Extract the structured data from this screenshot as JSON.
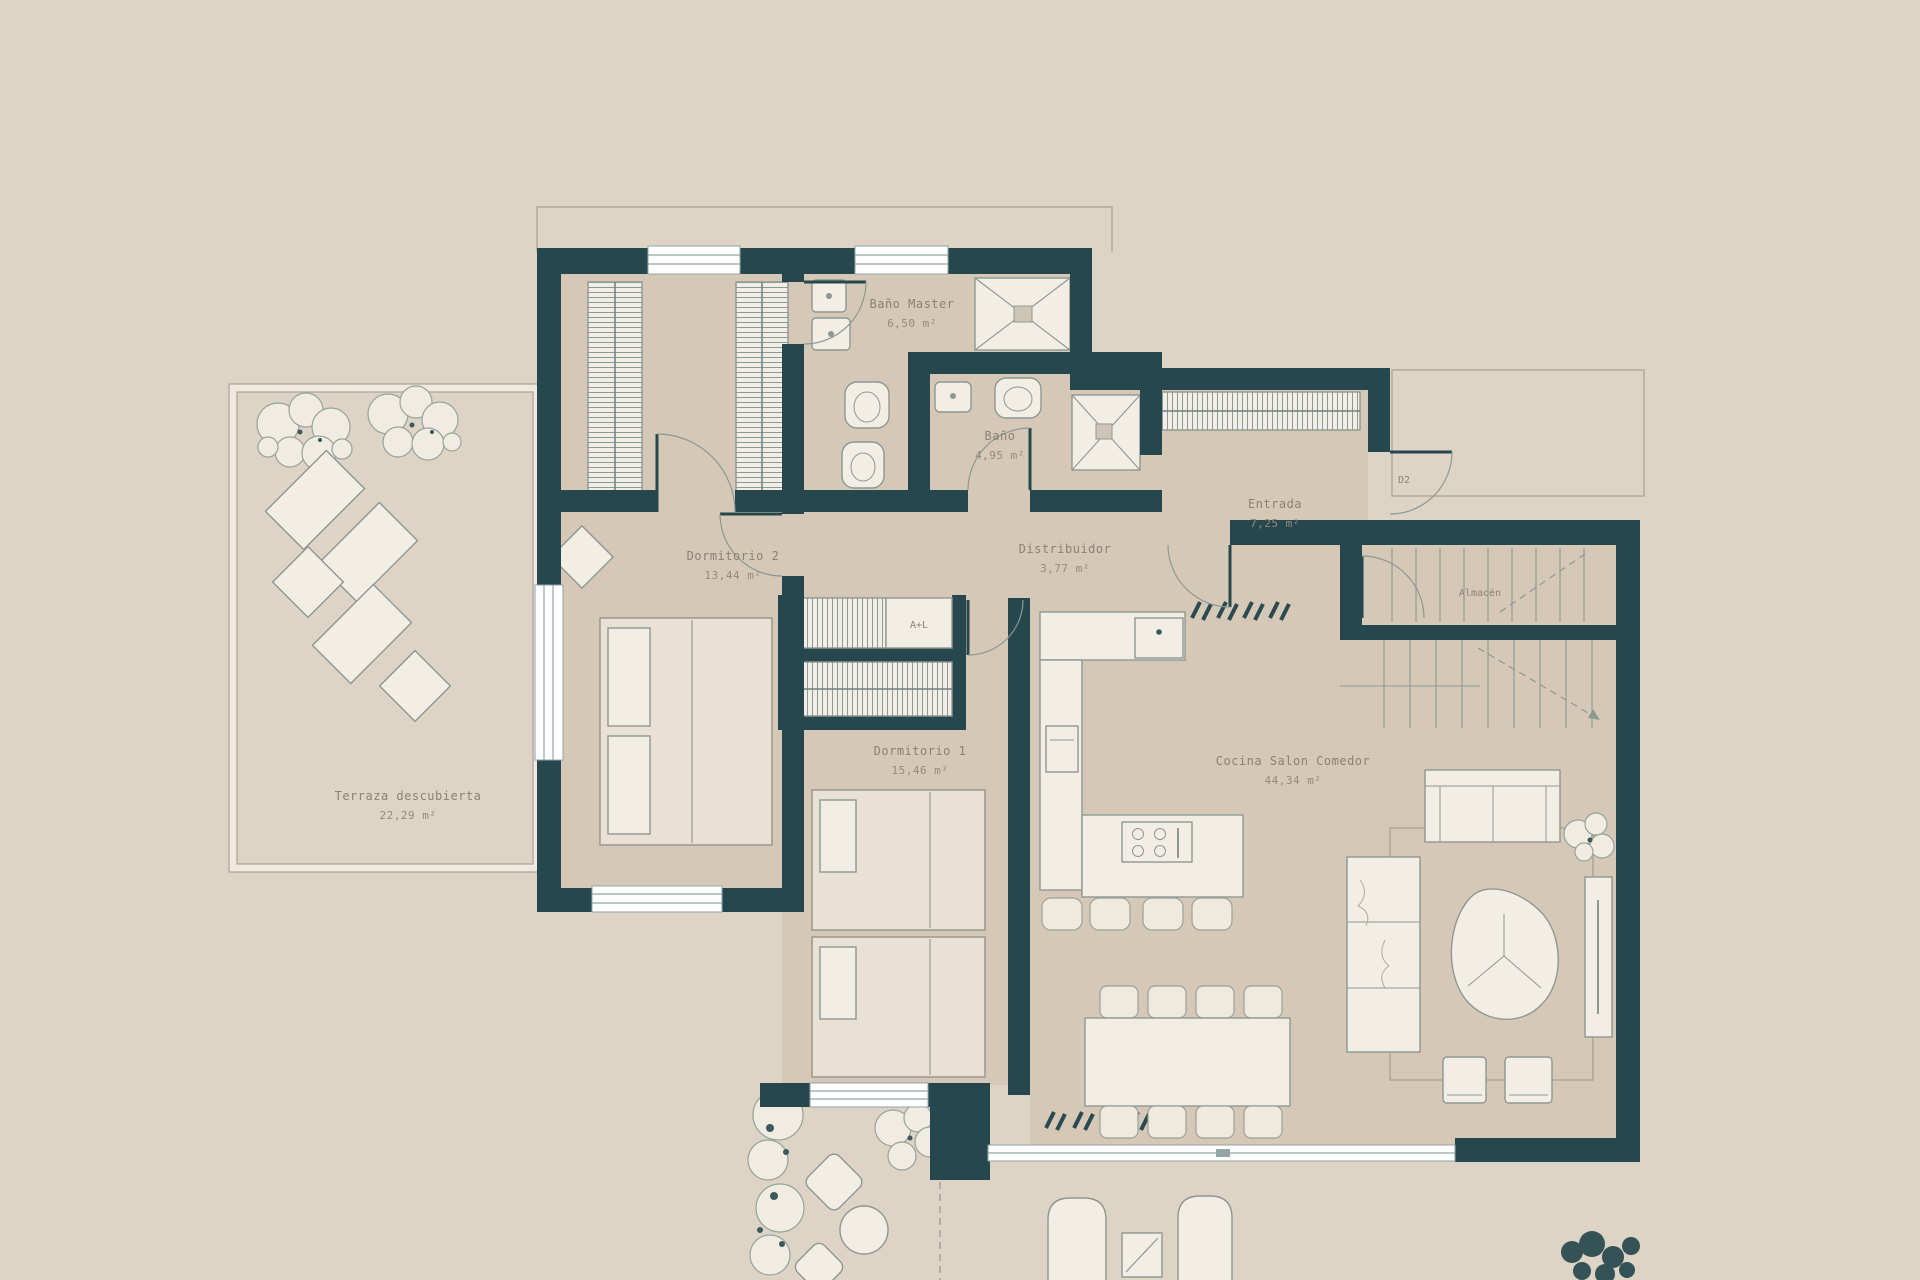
{
  "plan": {
    "title": "Plano de planta - vivienda",
    "rooms": [
      {
        "id": "terraza",
        "name": "Terraza descubierta",
        "area": "22,29 m²"
      },
      {
        "id": "dormitorio2",
        "name": "Dormitorio 2",
        "area": "13,44 m²"
      },
      {
        "id": "bano-master",
        "name": "Baño Master",
        "area": "6,50 m²"
      },
      {
        "id": "bano",
        "name": "Baño",
        "area": "4,95 m²"
      },
      {
        "id": "entrada",
        "name": "Entrada",
        "area": "7,25 m²"
      },
      {
        "id": "distribuidor",
        "name": "Distribuidor",
        "area": "3,77 m²"
      },
      {
        "id": "dormitorio1",
        "name": "Dormitorio 1",
        "area": "15,46 m²"
      },
      {
        "id": "cocina",
        "name": "Cocina Salon Comedor",
        "area": "44,34 m²"
      },
      {
        "id": "almacen",
        "name": "Almacén",
        "area": ""
      }
    ],
    "tags": {
      "closet_washer": "A+L",
      "entry_door": "D2"
    },
    "colors": {
      "wall": "#27474f",
      "background": "#ded4c6",
      "floor": "#d6c8b7",
      "furniture_stroke": "#8e9792",
      "label_text": "#8b8174"
    }
  }
}
